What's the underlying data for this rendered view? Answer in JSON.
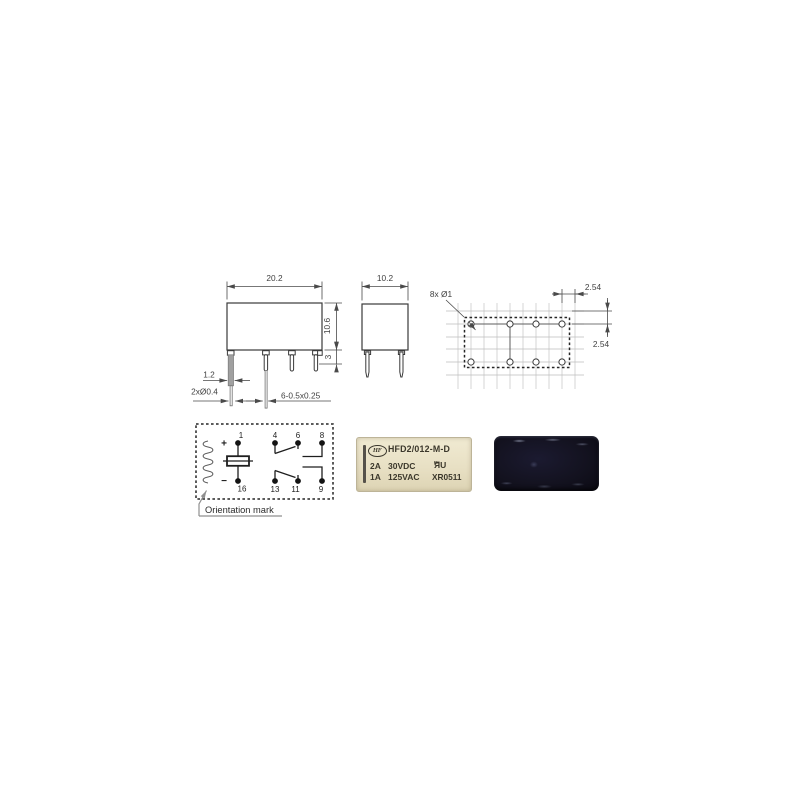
{
  "colors": {
    "page_bg": "#ffffff",
    "line": "#3a3a3a",
    "label_bg": "#e8e0c4",
    "label_text": "#3b372b",
    "photo_bg": "#13121f"
  },
  "side_view": {
    "width_dim": "20.2",
    "height_dim": "10.6",
    "standoff_dim": "3",
    "pin_edge_dim": "1.2",
    "coil_pin_dim": "2xØ0.4",
    "contact_pin_dim": "6-0.5x0.25"
  },
  "front_view": {
    "width_dim": "10.2"
  },
  "pcb_layout": {
    "hole_callout": "8x Ø1",
    "pitch_h": "2.54",
    "pitch_v": "2.54"
  },
  "schematic": {
    "pins_top": [
      "1",
      "4",
      "6",
      "8"
    ],
    "pins_bottom": [
      "16",
      "13",
      "11",
      "9"
    ],
    "polarity_plus": "+",
    "polarity_minus": "−",
    "orientation_label": "Orientation mark"
  },
  "label_photo": {
    "logo_text": "HF",
    "model": "HFD2/012-M-D",
    "rating1_current": "2A",
    "rating1_voltage": "30VDC",
    "rating2_current": "1A",
    "rating2_voltage": "125VAC",
    "ul_prefix": "c",
    "ul_mark": "ЯU",
    "ul_suffix": "us",
    "date_code": "XR0511"
  }
}
